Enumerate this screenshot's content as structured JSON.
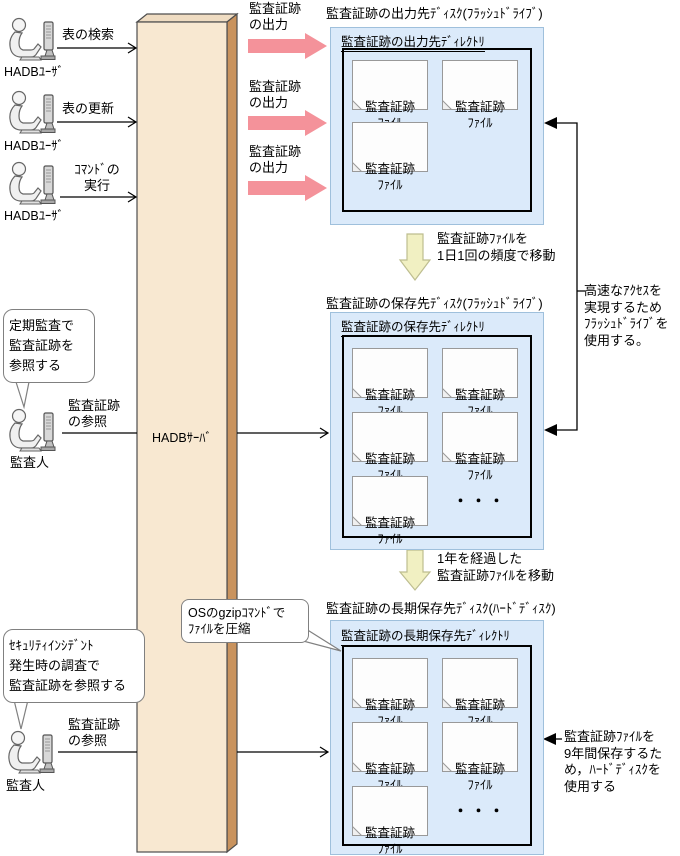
{
  "server": {
    "label": "HADBｻｰﾊﾞ"
  },
  "users": [
    {
      "icon": "user-at-computer-icon",
      "label": "HADBﾕｰｻﾞ",
      "action": "表の検索"
    },
    {
      "icon": "user-at-computer-icon",
      "label": "HADBﾕｰｻﾞ",
      "action": "表の更新"
    },
    {
      "icon": "user-at-computer-icon",
      "label": "HADBﾕｰｻﾞ",
      "action": "ｺﾏﾝﾄﾞの\n実行"
    }
  ],
  "output_arrows": [
    {
      "label": "監査証跡\nの出力"
    },
    {
      "label": "監査証跡\nの出力"
    },
    {
      "label": "監査証跡\nの出力"
    }
  ],
  "disks": [
    {
      "title": "監査証跡の出力先ﾃﾞｨｽｸ(ﾌﾗｯｼｭﾄﾞﾗｲﾌﾞ)",
      "directory": "監査証跡の出力先ﾃﾞｨﾚｸﾄﾘ",
      "files": [
        "監査証跡\nﾌｧｲﾙ",
        "監査証跡\nﾌｧｲﾙ",
        "監査証跡\nﾌｧｲﾙ"
      ]
    },
    {
      "title": "監査証跡の保存先ﾃﾞｨｽｸ(ﾌﾗｯｼｭﾄﾞﾗｲﾌﾞ)",
      "directory": "監査証跡の保存先ﾃﾞｨﾚｸﾄﾘ",
      "files": [
        "監査証跡\nﾌｧｲﾙ",
        "監査証跡\nﾌｧｲﾙ",
        "監査証跡\nﾌｧｲﾙ",
        "監査証跡\nﾌｧｲﾙ",
        "監査証跡\nﾌｧｲﾙ"
      ],
      "ellipsis": "・・・"
    },
    {
      "title": "監査証跡の長期保存先ﾃﾞｨｽｸ(ﾊｰﾄﾞﾃﾞｨｽｸ)",
      "directory": "監査証跡の長期保存先ﾃﾞｨﾚｸﾄﾘ",
      "files": [
        "監査証跡\nﾌｧｲﾙ",
        "監査証跡\nﾌｧｲﾙ",
        "監査証跡\nﾌｧｲﾙ",
        "監査証跡\nﾌｧｲﾙ",
        "監査証跡\nﾌｧｲﾙ"
      ],
      "ellipsis": "・・・"
    }
  ],
  "move_labels": [
    "監査証跡ﾌｧｲﾙを\n1日1回の頻度で移動",
    "1年を経過した\n監査証跡ﾌｧｲﾙを移動"
  ],
  "auditors": [
    {
      "icon": "auditor-at-computer-icon",
      "bubble": "定期監査で\n監査証跡を\n参照する",
      "label": "監査人",
      "action": "監査証跡\nの参照"
    },
    {
      "icon": "auditor-at-computer-icon",
      "bubble": "ｾｷｭﾘﾃｨｲﾝｼﾃﾞﾝﾄ\n発生時の調査で\n監査証跡を参照する",
      "label": "監査人",
      "action": "監査証跡\nの参照"
    }
  ],
  "notes": {
    "flash_drive": "高速なｱｸｾｽを\n実現するため\nﾌﾗｯｼｭﾄﾞﾗｲﾌﾞを\n使用する。",
    "gzip": "OSのgzipｺﾏﾝﾄﾞで\nﾌｧｲﾙを圧縮",
    "hard_disk": "監査証跡ﾌｧｲﾙを\n9年間保存するた\nめ，ﾊｰﾄﾞﾃﾞｨｽｸを\n使用する"
  },
  "colors": {
    "disk_box_fill": "#DBEAFA",
    "disk_box_border": "#9FC0DC",
    "output_arrow_pink": "#F4929A",
    "move_arrow_fill": "#F1F0C2",
    "move_arrow_border": "#BDBD8F",
    "server_front": "#F8E8D1",
    "server_side": "#C9935E",
    "server_top": "#EFDCC2"
  }
}
